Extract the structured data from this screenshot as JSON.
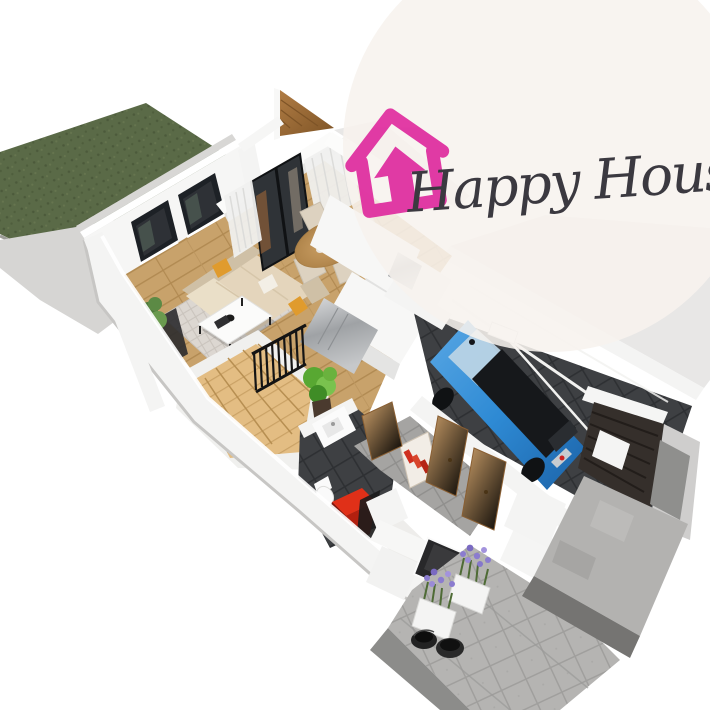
{
  "canvas": {
    "width": 710,
    "height": 710
  },
  "watermark": {
    "text": "Happy House",
    "icon": "house-arrow-icon",
    "badge_shape": "circle"
  },
  "palette": {
    "badge_bg": "#f7f2ee",
    "logo_pink": "#df2b9e",
    "logo_text": "#3b3940",
    "grass": "#5a6a47",
    "grass_dark": "#49573a",
    "wall_white": "#f4f4f3",
    "wall_shadow": "#d8d7d5",
    "wall_face": "#e8e7e6",
    "wood_floor": "#c8a26b",
    "wood_line": "#b18a52",
    "stair_wood": "#e3bd83",
    "rug": "#dcd7d1",
    "sofa": "#e4d5bc",
    "sofa_shade": "#cfc0a6",
    "pillow_orange": "#e09b2d",
    "table_wood": "#c2975c",
    "chair": "#ddd2c0",
    "curtain": "#f0f0ef",
    "glass_dark": "#2f3337",
    "accent_wood": "#a9763f",
    "kitchen_white": "#f7f7f6",
    "steel": "#b9bcbe",
    "garage_floor": "#3e4043",
    "car_blue": "#2e8ad4",
    "car_roof": "#16181b",
    "windshield": "#b9d3e5",
    "door_wood": "#bb8d55",
    "red_appliance": "#e03018",
    "bath_tile": "#45474a",
    "hall_tile": "#a5a4a2",
    "concrete": "#d6d5d3",
    "driveway": "#b3b2b0",
    "driveway_edge": "#757472",
    "path": "#b5b4b2",
    "path_edge": "#8c8c8a",
    "lavender": "#8b7ccf",
    "stem_green": "#4e6b35",
    "plant_green": "#5f9a3e",
    "pot_dark": "#222222",
    "mat_dark": "#28282a"
  },
  "scene": {
    "view": "isometric-3d-floor-plan",
    "rooms": [
      {
        "name": "garden",
        "objects": [
          "lawn",
          "concrete-edge"
        ]
      },
      {
        "name": "living-room",
        "objects": [
          "corner-sofa",
          "coffee-table",
          "rug",
          "tv-console",
          "potted-plant",
          "windows"
        ]
      },
      {
        "name": "dining-area",
        "objects": [
          "oval-table",
          "chairs",
          "curtains",
          "glass-doors",
          "wood-accent-wall"
        ]
      },
      {
        "name": "kitchen",
        "objects": [
          "counter",
          "island",
          "fridge"
        ]
      },
      {
        "name": "staircase",
        "objects": [
          "winder-stairs",
          "black-railing",
          "potted-plant"
        ]
      },
      {
        "name": "bathroom",
        "objects": [
          "sink",
          "toilet",
          "red-washing-machine"
        ]
      },
      {
        "name": "hallway",
        "objects": [
          "wooden-doors",
          "shelf-with-red-boxes"
        ]
      },
      {
        "name": "garage",
        "objects": [
          "blue-suv",
          "garage-door",
          "door-rails",
          "tiled-floor"
        ]
      },
      {
        "name": "entrance",
        "objects": [
          "doormat",
          "lavender-planters",
          "black-pots",
          "paver-walkway",
          "driveway"
        ]
      }
    ]
  }
}
